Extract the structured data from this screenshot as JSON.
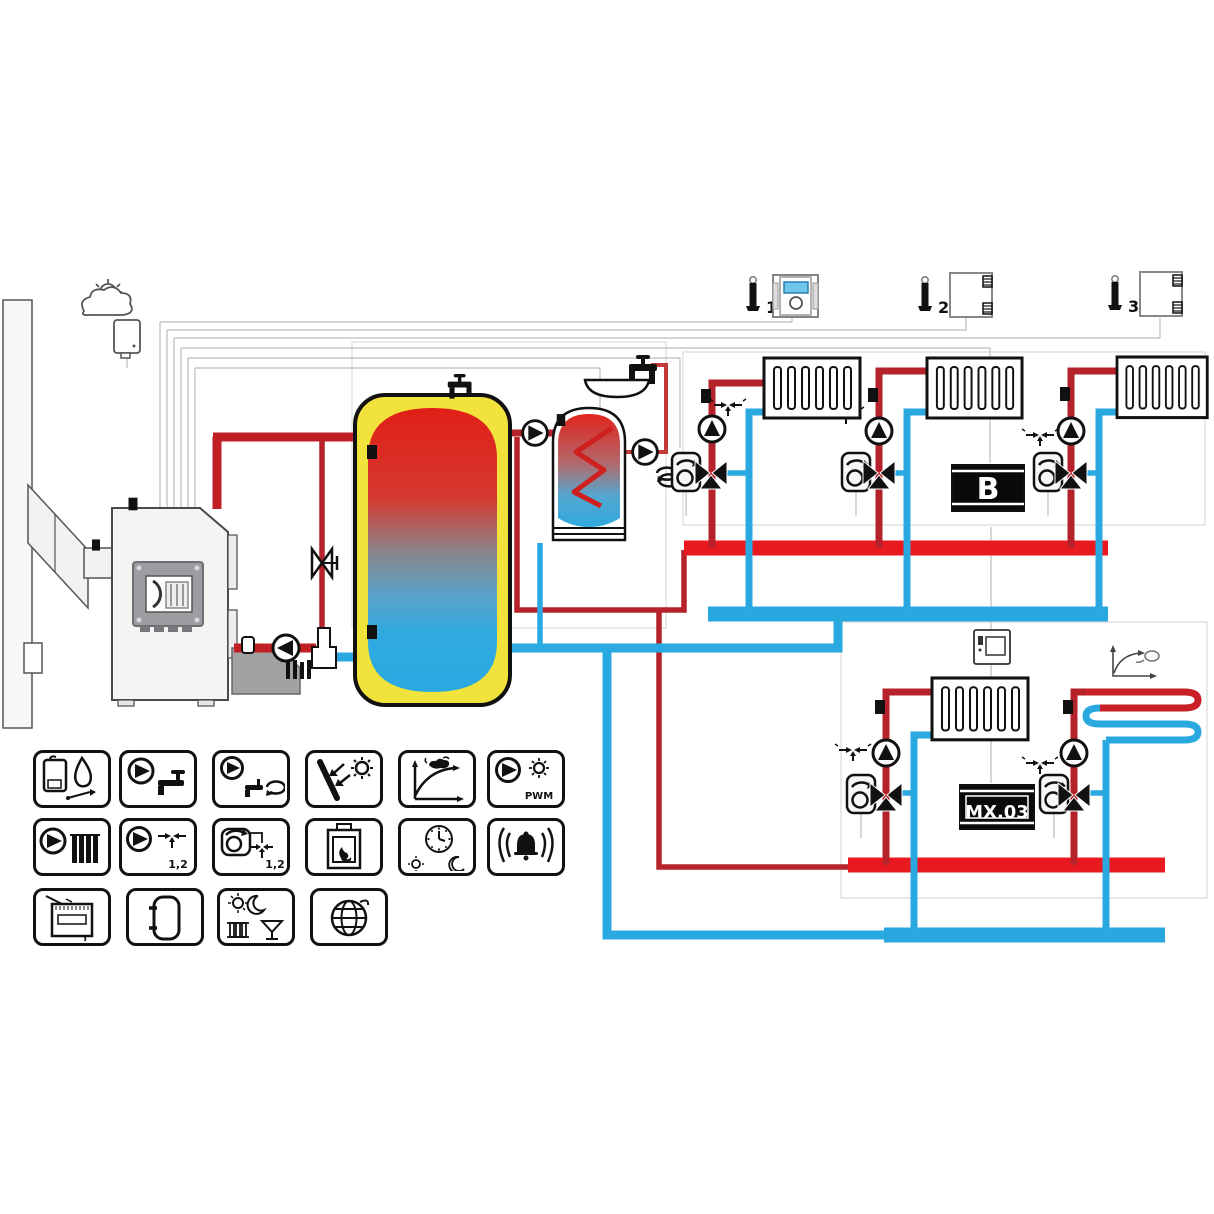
{
  "labels": {
    "b_box": "B",
    "mx_box": "MX.03"
  },
  "thermostats": {
    "t1": "1",
    "t2": "2",
    "t3": "3"
  },
  "legend": {
    "pwm": "PWM",
    "pairs_a": "1,2",
    "pairs_b": "1,2",
    "icons": [
      "boiler-burner-control",
      "dhw-pump",
      "dhw-circulation-pump",
      "solar-collector",
      "heating-curve",
      "pwm-solar-pump",
      "heating-circuit-pump",
      "pump-valves-1-2",
      "mixer-actuators-1-2",
      "fireplace-boiler",
      "time-program",
      "alarm",
      "room-controller",
      "buffer-tank",
      "day-night-party-modes",
      "internet-module"
    ]
  },
  "colors": {
    "hot_pipe": "#e8191f",
    "hot_pipe_thin": "#b5222a",
    "cold_pipe": "#2aa9e0",
    "tank_yellow": "#f2e23c",
    "wire_grey": "#bcbcbc",
    "lcd_blue": "#6ec6ea"
  }
}
